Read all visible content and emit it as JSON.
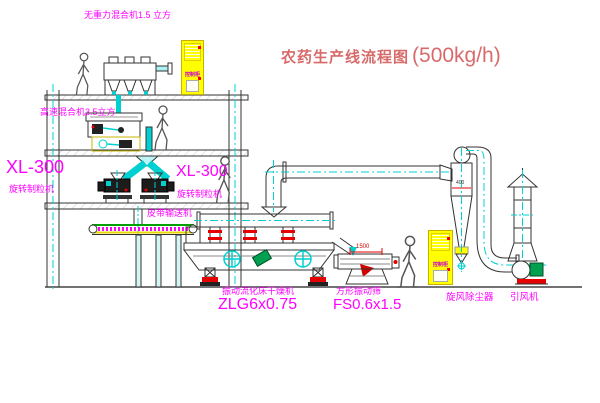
{
  "title": {
    "name": "农药生产线流程图",
    "capacity": "(500kg/h)"
  },
  "equipment_labels": {
    "gravity_free_mixer": "无重力混合机1.5 立方",
    "high_speed_mixer": "高速混合机3.5立方",
    "granulator_left": {
      "model": "XL-300",
      "name": "旋转制粒机"
    },
    "granulator_right": {
      "model": "XL-300",
      "name": "旋转制粒机"
    },
    "belt_conveyor": "皮带输送机",
    "fluid_bed_dryer": {
      "name": "振动流化床干燥机",
      "model": "ZLG6x0.75"
    },
    "square_vibrating_sieve": {
      "name": "方形振动筛",
      "model": "FS0.6x1.5"
    },
    "cyclone_dust_collector": "旋风除尘器",
    "induced_draft_fan": "引风机",
    "control_cabinet": "控制柜"
  },
  "dimensions": {
    "sieve_length": "1500",
    "cyclone_width": "400"
  },
  "colors": {
    "label_magenta": "#ff00ff",
    "title_red": "#d96a6a",
    "centerline_cyan": "#00d0d0",
    "cabinet_yellow": "#ffff00",
    "flange_red": "#e60000",
    "motor_green": "#00a050",
    "line_dark": "#333333"
  }
}
